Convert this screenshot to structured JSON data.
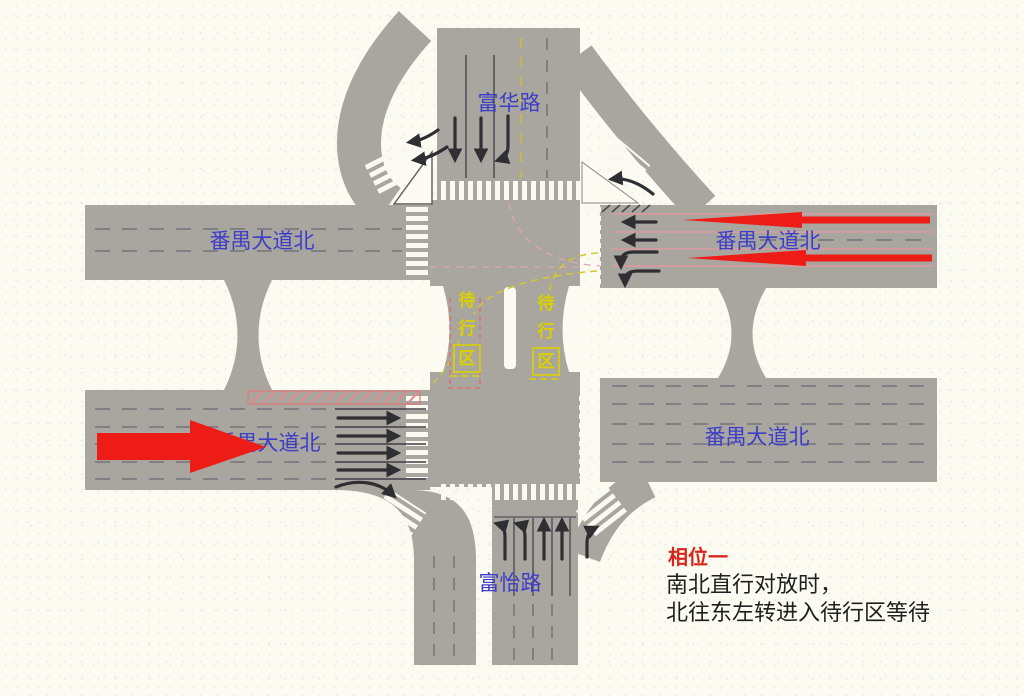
{
  "diagram": {
    "title_hint": "signal phase diagram of intersection",
    "colors": {
      "road_gray": "#a8a69e",
      "background": "#fbfbf1",
      "label_blue": "#3d3dca",
      "waiting_yellow": "#ddd000",
      "flow_red": "#ee1c16",
      "phase_red": "#d9261c",
      "text_dark": "#1f1f1f",
      "lane_pink": "#dc9aa0"
    },
    "roads": {
      "north": {
        "label": "富华路"
      },
      "west_upper": {
        "label": "番禺大道北"
      },
      "east_upper": {
        "label": "番禺大道北"
      },
      "west_lower": {
        "label": "番禺大道北"
      },
      "east_lower": {
        "label": "番禺大道北"
      },
      "south": {
        "label": "富怡路"
      }
    },
    "waiting_zone": {
      "chars": [
        "待",
        "行",
        "区"
      ]
    },
    "legend": {
      "phase_title": "相位一",
      "line1": "南北直行对放时，",
      "line2": "北往东左转进入待行区等待"
    }
  }
}
